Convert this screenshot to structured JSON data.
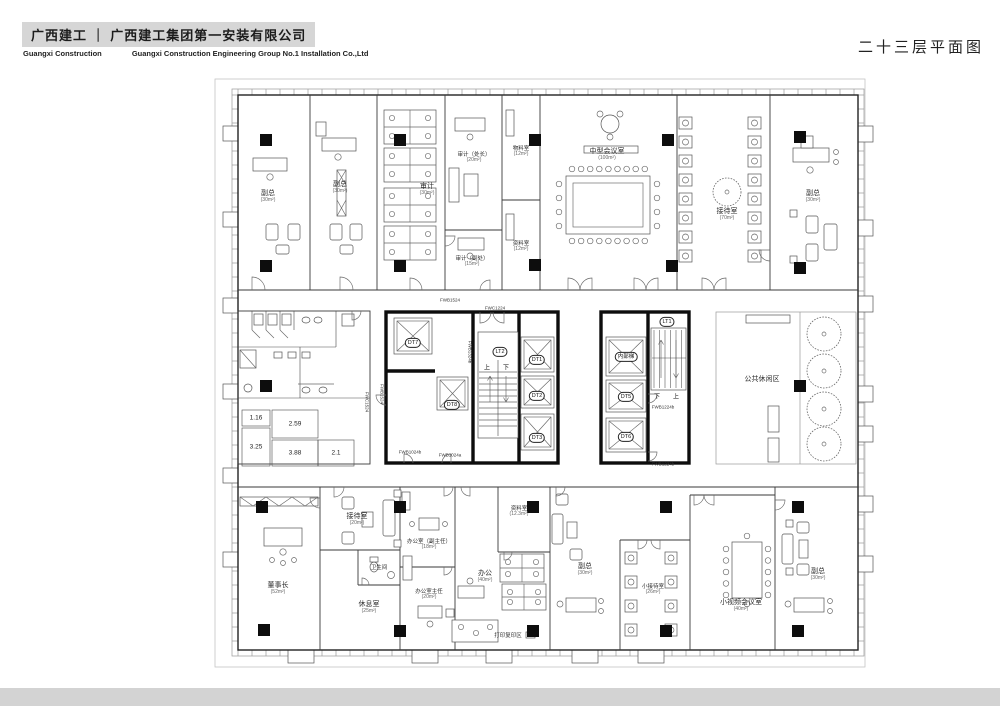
{
  "header": {
    "company_cn": "广西建工 ｜ 广西建工集团第一安装有限公司",
    "company_en1": "Guangxi Construction",
    "company_en2": "Guangxi Construction Engineering Group No.1 Installation Co.,Ltd",
    "drawing_title": "二十三层平面图"
  },
  "colors": {
    "banner_bg": "#d6d6d6",
    "paper": "#ffffff",
    "thin_wall": "#3a3a3a",
    "thick_wall": "#0d0d0d",
    "bottom_strip": "#d3d3d3"
  },
  "plan": {
    "rooms": [
      {
        "label": "副总",
        "sub": "(30m²)",
        "x": 268,
        "y": 197
      },
      {
        "label": "副总",
        "sub": "(30m²)",
        "x": 340,
        "y": 188
      },
      {
        "label": "审计",
        "sub": "(30m²)",
        "x": 427,
        "y": 190
      },
      {
        "label": "审计（处长）",
        "sub": "(20m²)",
        "x": 474,
        "y": 158,
        "small": true
      },
      {
        "label": "物料室",
        "sub": "(12m²)",
        "x": 521,
        "y": 152,
        "small": true
      },
      {
        "label": "资料室",
        "sub": "(12m²)",
        "x": 521,
        "y": 247,
        "small": true
      },
      {
        "label": "审计（副处）",
        "sub": "(15m²)",
        "x": 472,
        "y": 262,
        "small": true
      },
      {
        "label": "中型会议室",
        "sub": "(100m²)",
        "x": 607,
        "y": 155
      },
      {
        "label": "接待室",
        "sub": "(70m²)",
        "x": 727,
        "y": 215
      },
      {
        "label": "副总",
        "sub": "(30m²)",
        "x": 813,
        "y": 197
      },
      {
        "label": "公共休闲区",
        "x": 762,
        "y": 380
      },
      {
        "label": "董事长",
        "sub": "(52m²)",
        "x": 278,
        "y": 589
      },
      {
        "label": "接待室",
        "sub": "(20m²)",
        "x": 357,
        "y": 520
      },
      {
        "label": "卫生间",
        "x": 379,
        "y": 568,
        "small": true
      },
      {
        "label": "休息室",
        "sub": "(25m²)",
        "x": 369,
        "y": 608
      },
      {
        "label": "办公室（副主任）",
        "sub": "(18m²)",
        "x": 429,
        "y": 545,
        "small": true
      },
      {
        "label": "办公室主任",
        "sub": "(20m²)",
        "x": 429,
        "y": 595,
        "small": true
      },
      {
        "label": "资料室",
        "sub": "(12.3m²)",
        "x": 519,
        "y": 512,
        "small": true
      },
      {
        "label": "办公",
        "sub": "(40m²)",
        "x": 485,
        "y": 577
      },
      {
        "label": "打印复印区",
        "x": 508,
        "y": 636,
        "small": true
      },
      {
        "label": "副总",
        "sub": "(30m²)",
        "x": 585,
        "y": 570
      },
      {
        "label": "小接待室",
        "sub": "(26m²)",
        "x": 653,
        "y": 590,
        "small": true
      },
      {
        "label": "小视频会议室",
        "sub": "(40m²)",
        "x": 741,
        "y": 606
      },
      {
        "label": "副总",
        "sub": "(30m²)",
        "x": 818,
        "y": 575
      }
    ],
    "core_labels": [
      {
        "label": "DT7",
        "x": 413,
        "y": 343
      },
      {
        "label": "DT8",
        "x": 452,
        "y": 405
      },
      {
        "label": "DT1",
        "x": 537,
        "y": 360
      },
      {
        "label": "DT2",
        "x": 537,
        "y": 396
      },
      {
        "label": "DT3",
        "x": 537,
        "y": 438
      },
      {
        "label": "LT2",
        "x": 500,
        "y": 352
      },
      {
        "label": "内部梯",
        "x": 626,
        "y": 357
      },
      {
        "label": "DT5",
        "x": 626,
        "y": 397
      },
      {
        "label": "DT6",
        "x": 626,
        "y": 437
      },
      {
        "label": "LT1",
        "x": 667,
        "y": 322
      }
    ],
    "stair_marks": [
      {
        "label": "上",
        "x": 487,
        "y": 367
      },
      {
        "label": "下",
        "x": 506,
        "y": 367
      },
      {
        "label": "下",
        "x": 657,
        "y": 396
      },
      {
        "label": "上",
        "x": 676,
        "y": 396
      }
    ],
    "door_labels": [
      {
        "label": "FWB1524",
        "x": 450,
        "y": 300
      },
      {
        "label": "FWC1224",
        "x": 495,
        "y": 308
      },
      {
        "label": "FWB1324b",
        "x": 470,
        "y": 352,
        "vertical": true
      },
      {
        "label": "FWB1524",
        "x": 382,
        "y": 394,
        "vertical": true
      },
      {
        "label": "FWC1524",
        "x": 367,
        "y": 402,
        "vertical": true
      },
      {
        "label": "FWB1024b",
        "x": 410,
        "y": 452
      },
      {
        "label": "FWB1024a",
        "x": 450,
        "y": 455
      },
      {
        "label": "FWB1224b",
        "x": 663,
        "y": 407
      },
      {
        "label": "FWB1224b",
        "x": 663,
        "y": 464
      }
    ],
    "dims": [
      {
        "label": "1.16",
        "x": 256,
        "y": 418
      },
      {
        "label": "2.59",
        "x": 295,
        "y": 424
      },
      {
        "label": "3.25",
        "x": 256,
        "y": 447
      },
      {
        "label": "3.88",
        "x": 295,
        "y": 453
      },
      {
        "label": "2.1",
        "x": 336,
        "y": 453
      }
    ]
  }
}
